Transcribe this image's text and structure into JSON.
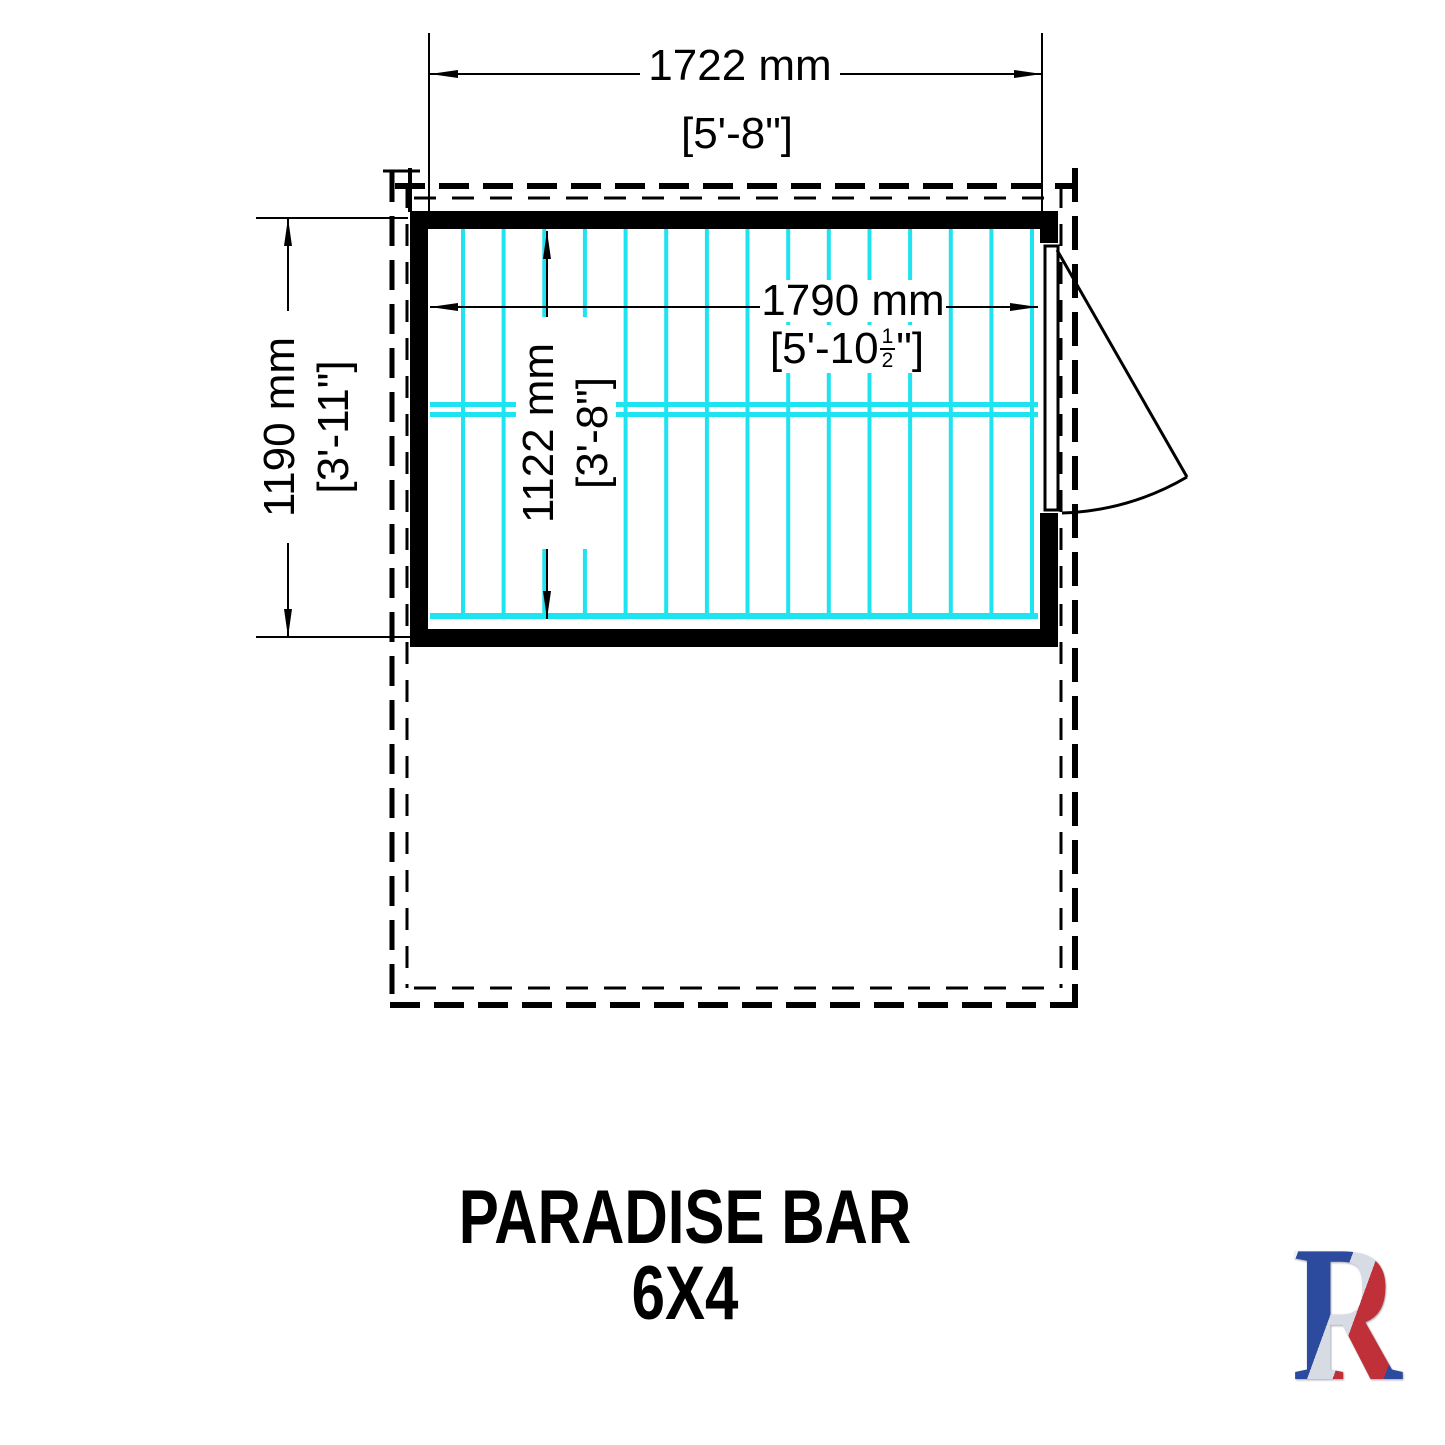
{
  "title": "PARADISE BAR 6X4",
  "dimensions": {
    "overall_width": {
      "mm": "1722 mm",
      "imperial": "[5'-8\"]"
    },
    "overall_depth": {
      "mm": "1190 mm",
      "imperial": "[3'-11\"]"
    },
    "internal_width": {
      "mm": "1790 mm",
      "imperial_pre": "[5'-10",
      "fraction_num": "1",
      "fraction_den": "2",
      "imperial_post": "\"]"
    },
    "internal_depth": {
      "mm": "1122 mm",
      "imperial": "[3'-8\"]"
    }
  },
  "logo": {
    "letters": [
      "S",
      "H",
      "I",
      "R",
      "E"
    ],
    "tagline": "BUILT AROUND OUR REPUTATION"
  },
  "colors": {
    "floor_boards": "#1ee3f0",
    "drawing_lines": "#000000",
    "logo_navy": "#27418f",
    "logo_red": "#b92d32"
  }
}
